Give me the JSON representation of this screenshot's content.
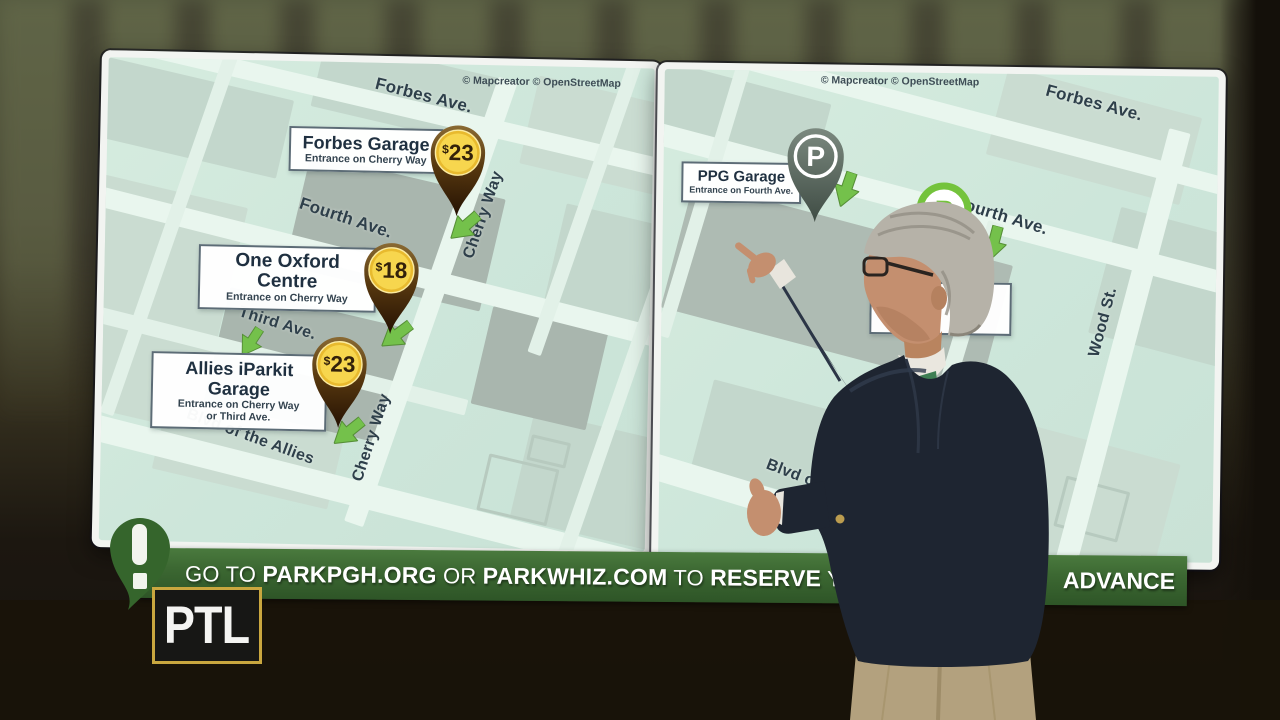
{
  "left_map": {
    "attribution": "© Mapcreator © OpenStreetMap",
    "streets": {
      "forbes": "Forbes Ave.",
      "fourth": "Fourth Ave.",
      "third": "Third Ave.",
      "blvd": "Blvd of the Allies",
      "cherry_upper": "Cherry Way",
      "cherry_lower": "Cherry Way"
    },
    "garages": [
      {
        "name": "Forbes Garage",
        "entrance": "Entrance on Cherry Way",
        "price_symbol": "$",
        "price_value": "23"
      },
      {
        "name": "One Oxford Centre",
        "entrance": "Entrance on Cherry Way",
        "price_symbol": "$",
        "price_value": "18"
      },
      {
        "name": "Allies iParkit Garage",
        "entrance": "Entrance on Cherry Way",
        "entrance_line2": "or Third Ave.",
        "price_symbol": "$",
        "price_value": "23"
      }
    ]
  },
  "right_map": {
    "attribution": "© Mapcreator © OpenStreetMap",
    "streets": {
      "forbes": "Forbes Ave.",
      "fourth": "Fourth Ave.",
      "wood": "Wood St.",
      "blvd_partial": "Blvd of th"
    },
    "garages": [
      {
        "name": "PPG Garage",
        "entrance": "Entrance on Fourth Ave.",
        "pin_letter": "P"
      }
    ],
    "green_marker_letter": "P"
  },
  "banner": {
    "segments": [
      {
        "text": "GO TO ",
        "bold": false
      },
      {
        "text": "PARKPGH.ORG",
        "bold": true
      },
      {
        "text": " OR ",
        "bold": false
      },
      {
        "text": "PARKWHIZ.COM",
        "bold": true
      },
      {
        "text": " TO ",
        "bold": false
      },
      {
        "text": "RESERVE",
        "bold": true
      },
      {
        "text": " YO",
        "bold": false
      }
    ],
    "right_text": "ADVANCE"
  },
  "logo": {
    "text": "PTL"
  },
  "colors": {
    "banner_green": "#3c6832",
    "pin_brown": "#4a2c12",
    "pin_gold": "#f2cd45",
    "arrow_green": "#74c14b",
    "marker_gray": "#5f6d63",
    "marker_bright_green": "#74c33c",
    "logo_border_gold": "#c9a73f",
    "map_bg": "#cde6da"
  }
}
